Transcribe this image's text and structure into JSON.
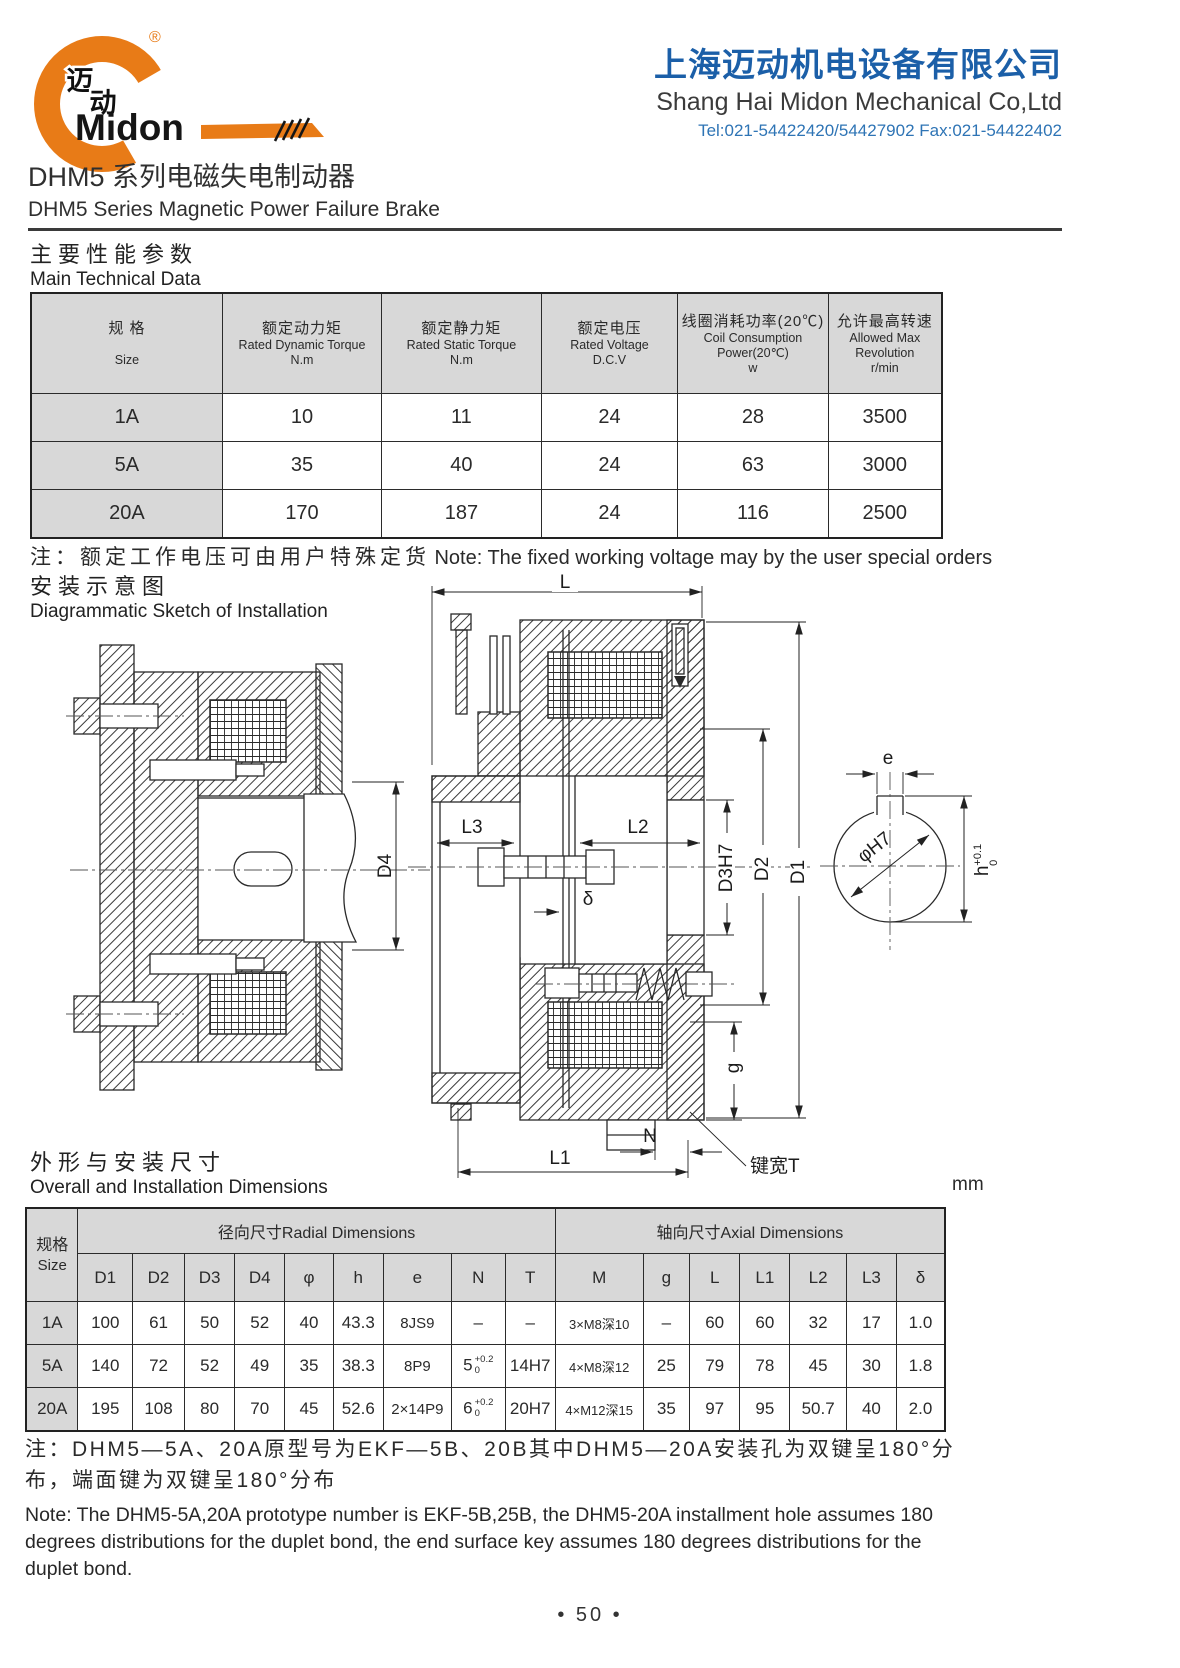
{
  "logo": {
    "brand": "Midon",
    "zh1": "迈",
    "zh2": "动",
    "registered": "®"
  },
  "company": {
    "name_zh": "上海迈动机电设备有限公司",
    "name_en": "Shang Hai Midon Mechanical Co,Ltd",
    "contact": "Tel:021-54422420/54427902 Fax:021-54422402"
  },
  "title": {
    "zh": "DHM5 系列电磁失电制动器",
    "en": "DHM5 Series Magnetic Power Failure Brake"
  },
  "sections": {
    "tech": {
      "zh": "主要性能参数",
      "en": "Main Technical Data"
    },
    "install": {
      "zh": "安装示意图",
      "en": "Diagrammatic Sketch of Installation"
    },
    "dims": {
      "zh": "外形与安装尺寸",
      "en": "Overall and Installation Dimensions",
      "unit": "mm"
    }
  },
  "table1": {
    "headers": [
      {
        "lines": [
          "规  格",
          "",
          "Size"
        ]
      },
      {
        "lines": [
          "额定动力矩",
          "Rated Dynamic Torque",
          "N.m"
        ]
      },
      {
        "lines": [
          "额定静力矩",
          "Rated Static Torque",
          "N.m"
        ]
      },
      {
        "lines": [
          "额定电压",
          "Rated Voltage",
          "D.C.V"
        ]
      },
      {
        "lines": [
          "线圈消耗功率(20℃)",
          "Coil Consumption",
          "Power(20℃)",
          "w"
        ]
      },
      {
        "lines": [
          "允许最高转速",
          "Allowed Max Revolution",
          "r/min"
        ]
      }
    ],
    "rows": [
      [
        "1A",
        "10",
        "11",
        "24",
        "28",
        "3500"
      ],
      [
        "5A",
        "35",
        "40",
        "24",
        "63",
        "3000"
      ],
      [
        "20A",
        "170",
        "187",
        "24",
        "116",
        "2500"
      ]
    ]
  },
  "note1": {
    "zh": "注：额定工作电压可由用户特殊定货",
    "en": "Note: The fixed working voltage may by the user special orders"
  },
  "table2": {
    "size_header": {
      "zh": "规格",
      "en": "Size"
    },
    "groups": [
      {
        "label": "径向尺寸Radial Dimensions",
        "span": 9
      },
      {
        "label": "轴向尺寸Axial Dimensions",
        "span": 7
      }
    ],
    "columns": [
      "D1",
      "D2",
      "D3",
      "D4",
      "φ",
      "h",
      "e",
      "N",
      "T",
      "M",
      "g",
      "L",
      "L1",
      "L2",
      "L3",
      "δ"
    ],
    "rows": [
      [
        "1A",
        "100",
        "61",
        "50",
        "52",
        "40",
        "43.3",
        "8JS9",
        "–",
        "–",
        "3×M8深10",
        "–",
        "60",
        "60",
        "32",
        "17",
        "1.0"
      ],
      [
        "5A",
        "140",
        "72",
        "52",
        "49",
        "35",
        "38.3",
        "8P9",
        {
          "v": "5",
          "sup": "+0.2",
          "sub": "0"
        },
        "14H7",
        "4×M8深12",
        "25",
        "79",
        "78",
        "45",
        "30",
        "1.8"
      ],
      [
        "20A",
        "195",
        "108",
        "80",
        "70",
        "45",
        "52.6",
        "2×14P9",
        {
          "v": "6",
          "sup": "+0.2",
          "sub": "0"
        },
        "20H7",
        "4×M12深15",
        "35",
        "97",
        "95",
        "50.7",
        "40",
        "2.0"
      ]
    ]
  },
  "note2": {
    "zh": "注：DHM5—5A、20A原型号为EKF—5B、20B其中DHM5—20A安装孔为双键呈180°分布，端面键为双键呈180°分布",
    "en": "Note: The DHM5-5A,20A prototype number is EKF-5B,25B, the DHM5-20A installment hole assumes 180 degrees distributions for the duplet bond, the end surface key assumes 180 degrees distributions for the duplet bond."
  },
  "drawing": {
    "labels": {
      "L": "L",
      "L1": "L1",
      "L2": "L2",
      "L3": "L3",
      "D1": "D1",
      "D2": "D2",
      "D3": "D3H7",
      "D4": "D4",
      "delta": "δ",
      "g": "g",
      "N": "N",
      "key_width": "键宽T",
      "e": "e",
      "phi": "φH7",
      "h": "h",
      "h_sup": "+0.1",
      "h_sub": "0"
    }
  },
  "page": {
    "number": "• 50 •"
  },
  "colors": {
    "accent_orange": "#e87b17",
    "brand_blue": "#1b5fa8",
    "tel_blue": "#2e74b5",
    "ink": "#2a2a2a",
    "table_header_bg": "#d8d8d8"
  }
}
